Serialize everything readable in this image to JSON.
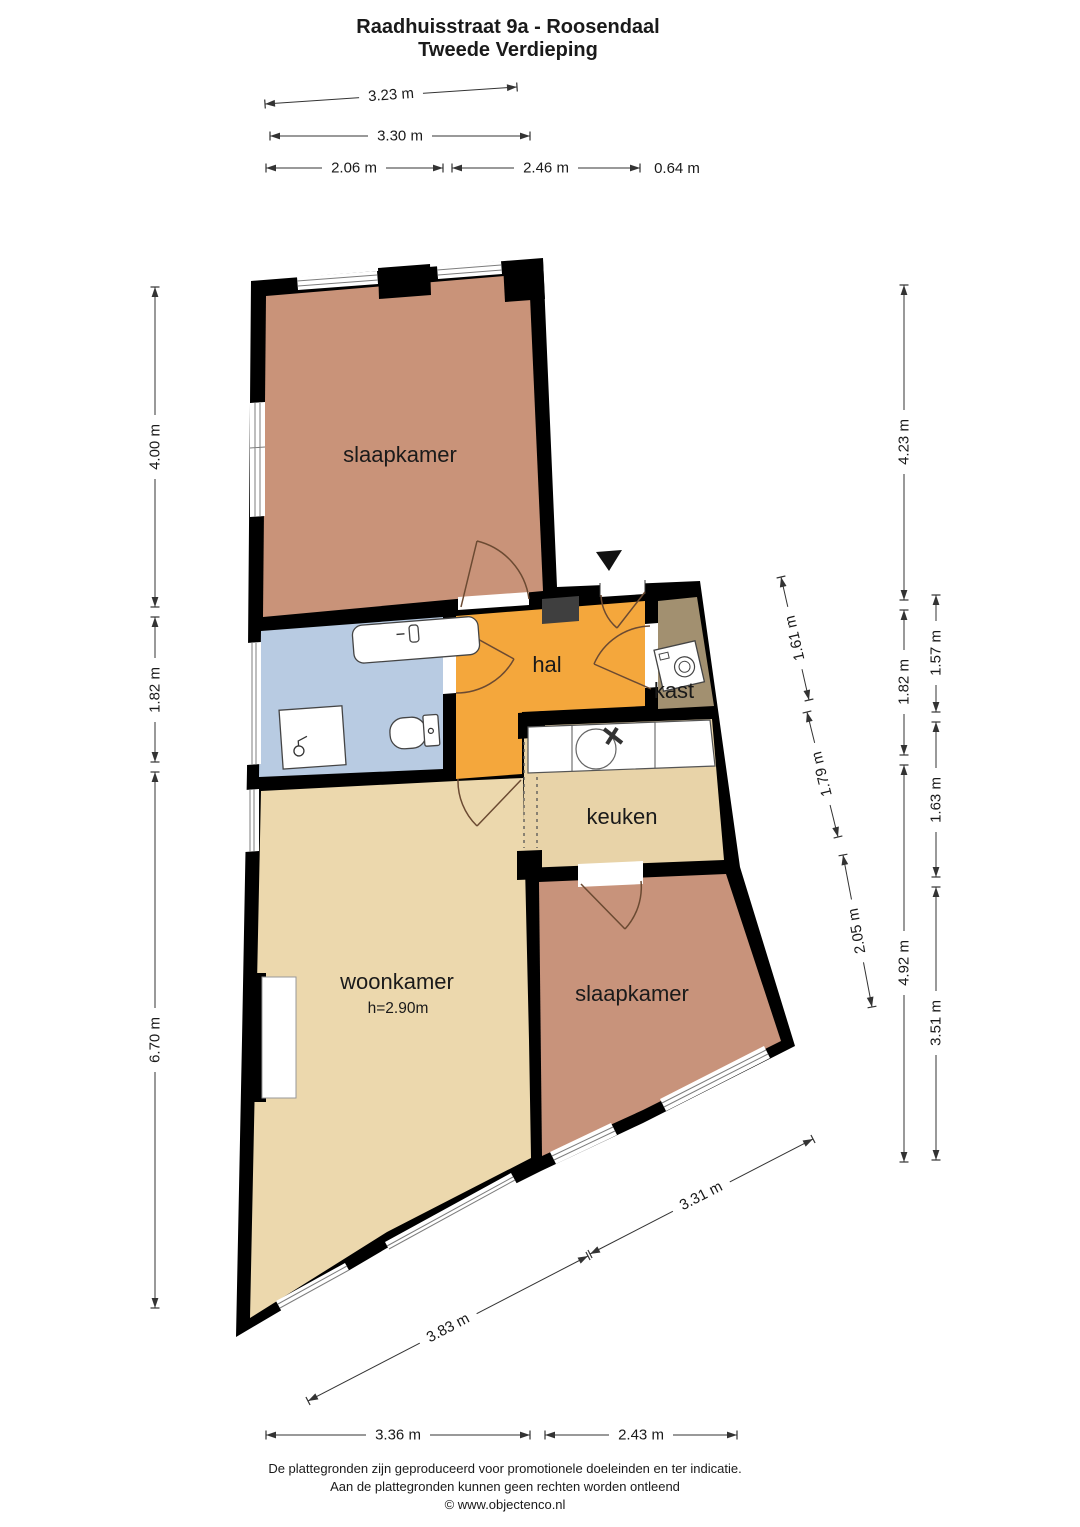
{
  "title": {
    "line1": "Raadhuisstraat 9a - Roosendaal",
    "line2": "Tweede Verdieping"
  },
  "rooms": {
    "slaapkamer_top": "slaapkamer",
    "hal": "hal",
    "kast": "kast",
    "keuken": "keuken",
    "woonkamer": "woonkamer",
    "woonkamer_height": "h=2.90m",
    "slaapkamer_bottom": "slaapkamer"
  },
  "colors": {
    "wall": "#000000",
    "slaapkamer_top": "#c99379",
    "slaapkamer_bottom": "#c8937b",
    "badkamer": "#b8cbe2",
    "hal": "#f4a73c",
    "kast": "#a29070",
    "keuken": "#e8d3a8",
    "woonkamer": "#ecd8ad",
    "shaft": "#3f3f3f"
  },
  "dimensions": {
    "top": {
      "d1": "3.23 m",
      "d2": "3.30 m",
      "d3": "2.06 m",
      "d4": "2.46 m",
      "d5": "0.64 m"
    },
    "left": {
      "d1": "4.00 m",
      "d2": "1.82 m",
      "d3": "6.70 m"
    },
    "right_outer": {
      "d1": "4.23 m",
      "d2": "1.82 m",
      "d3": "4.92 m"
    },
    "right_far": {
      "d1": "1.57 m",
      "d2": "1.63 m",
      "d3": "3.51 m"
    },
    "right_inner": {
      "d1": "1.61 m",
      "d2": "1.79 m",
      "d3": "2.05 m"
    },
    "bottom_slanted": {
      "d1": "3.83 m",
      "d2": "3.31 m"
    },
    "bottom": {
      "d1": "3.36 m",
      "d2": "2.43 m"
    }
  },
  "footer": {
    "line1": "De plattegronden zijn geproduceerd voor promotionele doeleinden en ter indicatie.",
    "line2": "Aan de plattegronden kunnen geen rechten worden ontleend",
    "line3": "© www.objectenco.nl"
  }
}
